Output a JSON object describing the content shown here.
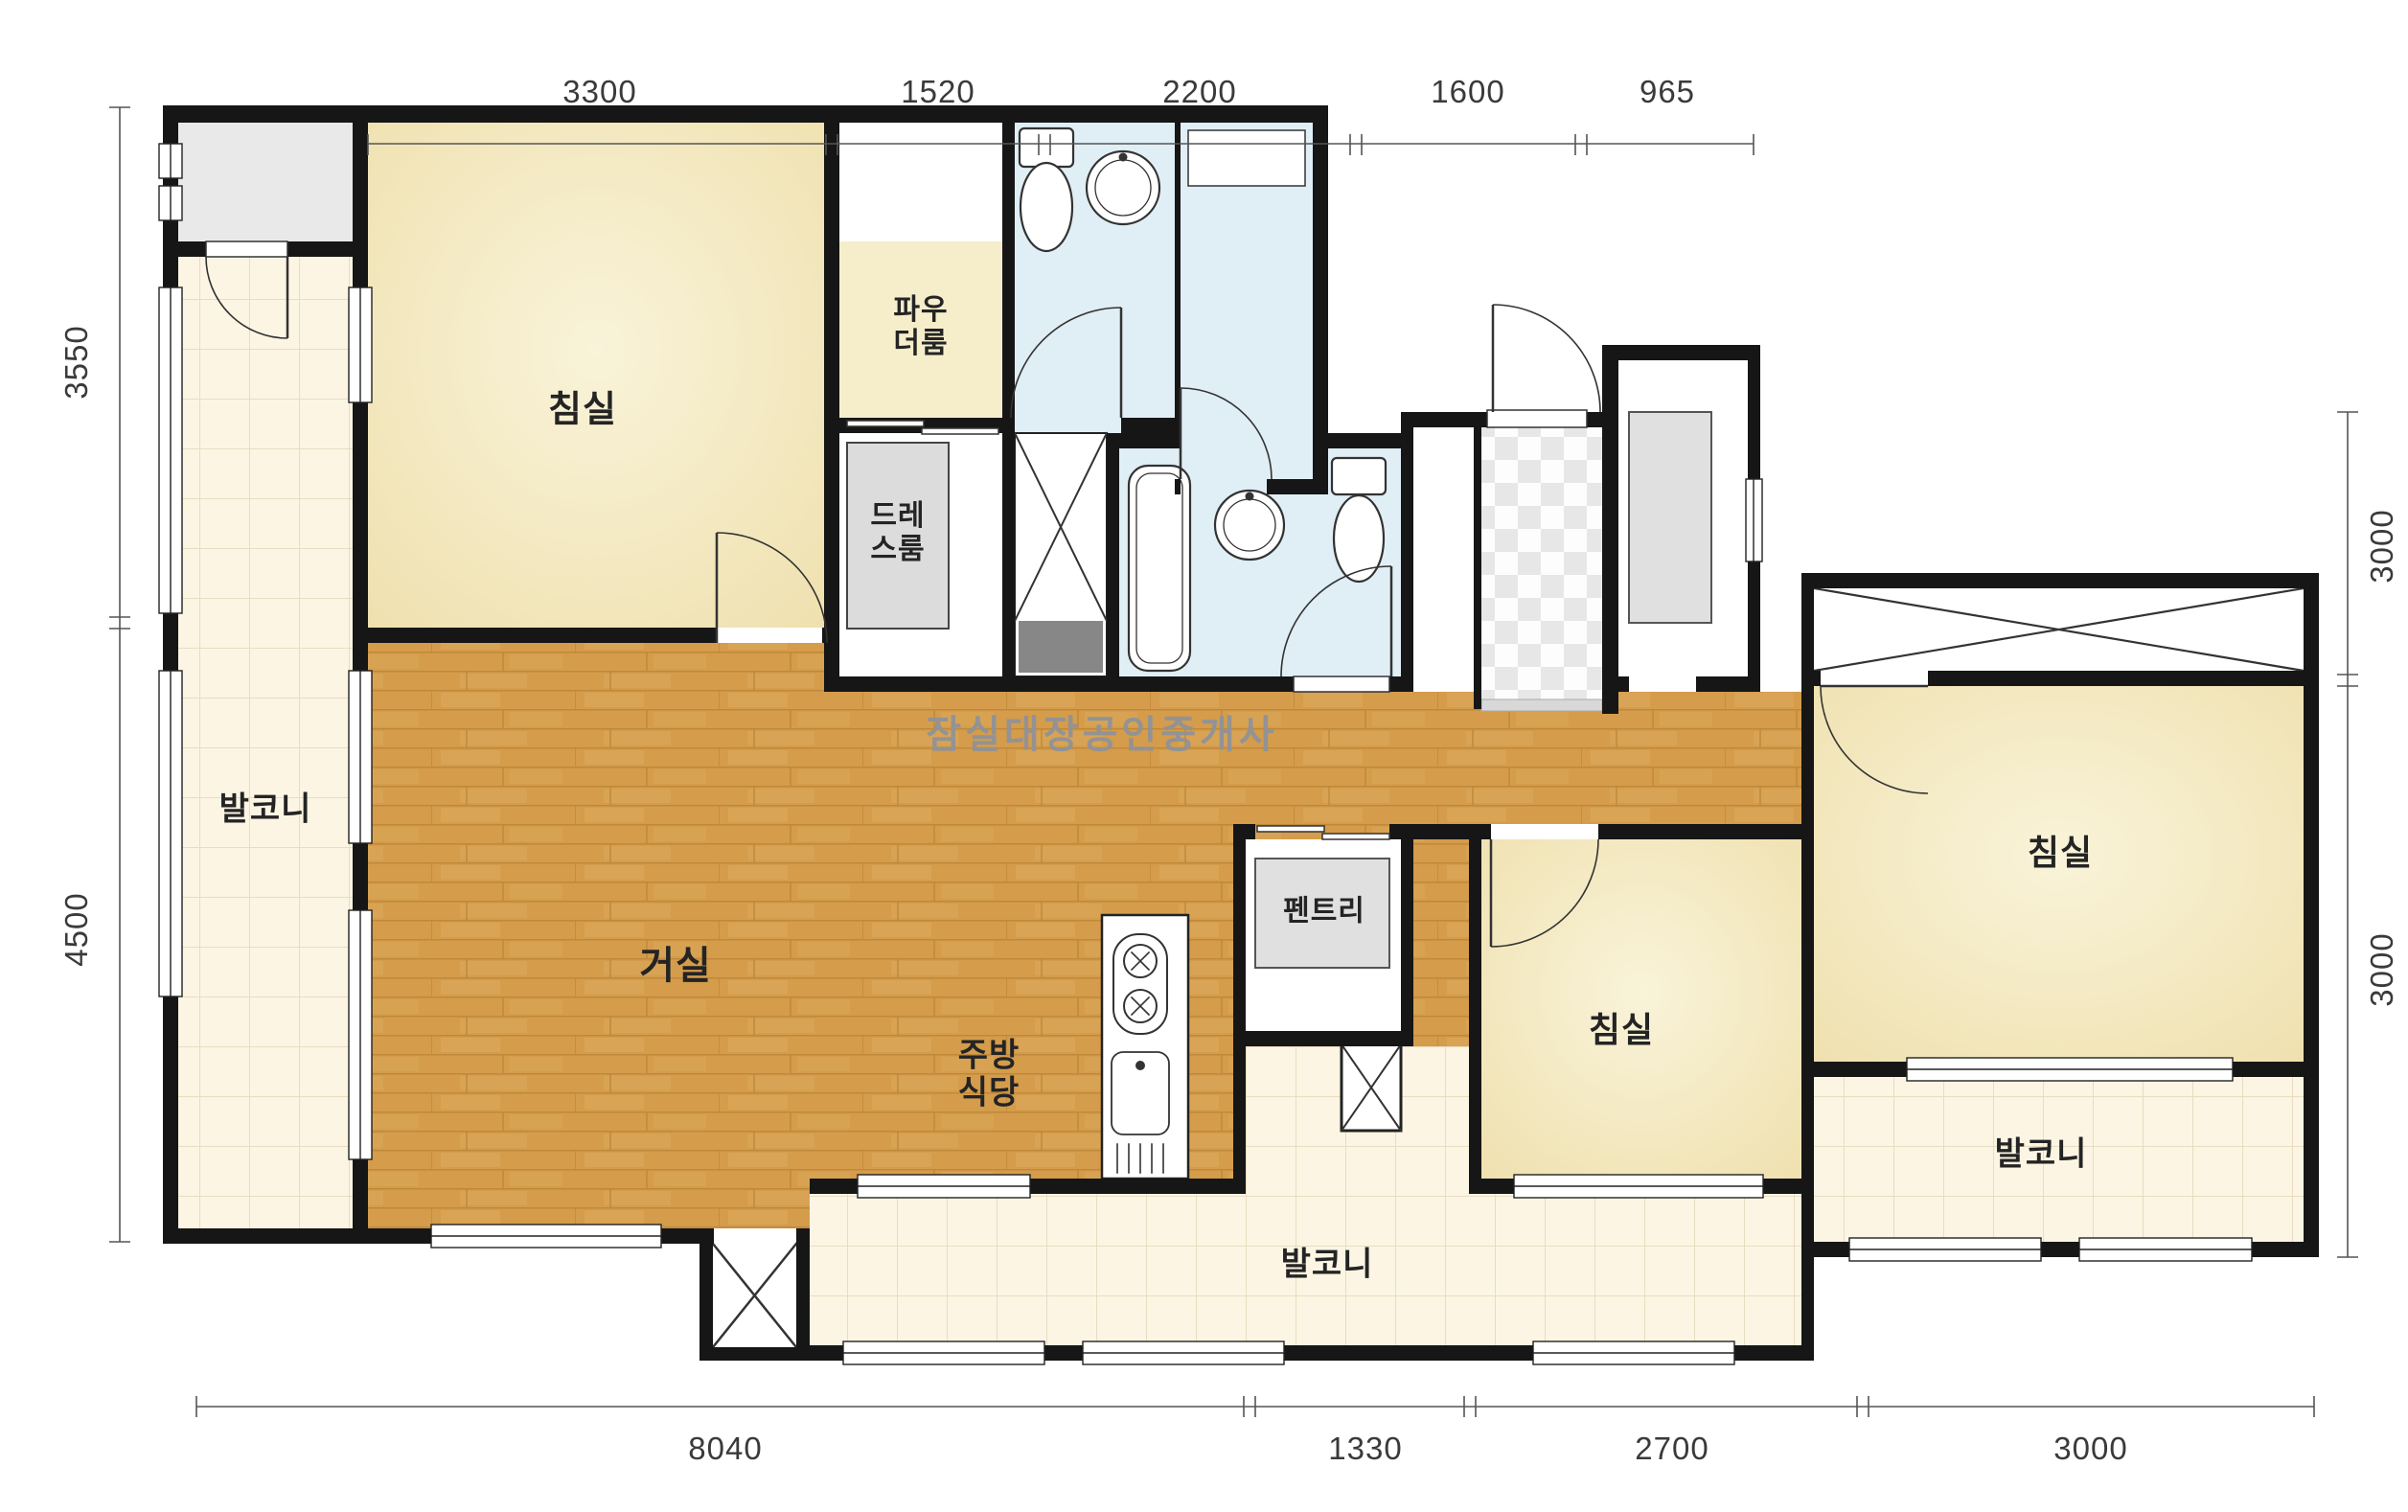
{
  "watermark": "잠실대장공인중개사",
  "rooms": {
    "bedroom_top_left": "침실",
    "bedroom_middle": "침실",
    "bedroom_right": "침실",
    "living_room": "거실",
    "kitchen_dining": "주방\n식당",
    "powder_room": "파우\n더룸",
    "dress_room": "드레\n스룸",
    "pantry": "펜트리",
    "balcony_left": "발코니",
    "balcony_bottom": "발코니",
    "balcony_right": "발코니"
  },
  "dimensions": {
    "top": [
      "3300",
      "1520",
      "2200",
      "1600",
      "965"
    ],
    "left": [
      "3550",
      "4500"
    ],
    "right": [
      "3000",
      "3000"
    ],
    "bottom": [
      "8040",
      "1330",
      "2700",
      "3000"
    ]
  },
  "colors": {
    "wall": "#161616",
    "wood_floor": "#d49c4b",
    "tile_floor": "#fcf5e3",
    "bathroom": "#e0eef5",
    "bedroom_cream": "#f4e8c0",
    "gray_room": "#e9e9e9"
  }
}
